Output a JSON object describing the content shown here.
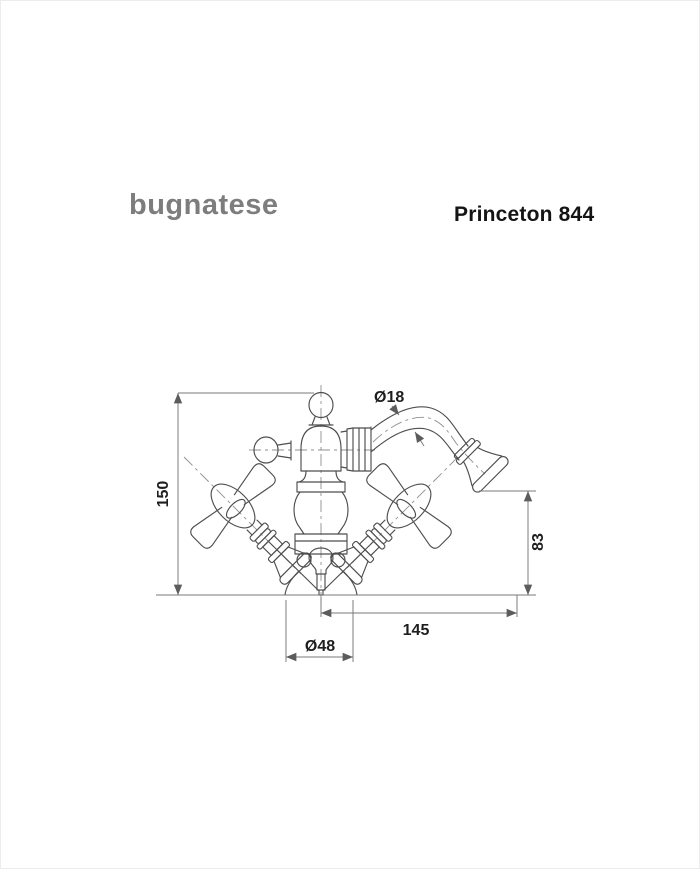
{
  "header": {
    "brand": "bugnatese",
    "product": "Princeton 844"
  },
  "drawing": {
    "subject_labels": [
      "Ø18",
      "150",
      "83",
      "145",
      "Ø48"
    ],
    "dimensions": [
      {
        "id": "spout-tube-diameter",
        "label": "Ø18",
        "value": 18,
        "orientation": "leader"
      },
      {
        "id": "overall-height",
        "label": "150",
        "value": 150,
        "orientation": "vertical-left"
      },
      {
        "id": "spout-outlet-height",
        "label": "83",
        "value": 83,
        "orientation": "vertical-right"
      },
      {
        "id": "spout-reach",
        "label": "145",
        "value": 145,
        "orientation": "horizontal"
      },
      {
        "id": "base-diameter",
        "label": "Ø48",
        "value": 48,
        "orientation": "horizontal"
      }
    ],
    "colors": {
      "outline": "#4e4e4e",
      "dimension_lines": "#787878",
      "centerlines": "#8f8f8f",
      "label_text": "#1e1e1e",
      "brand_gray": "#7d7d7d",
      "title_text": "#141414",
      "background": "#ffffff"
    }
  }
}
